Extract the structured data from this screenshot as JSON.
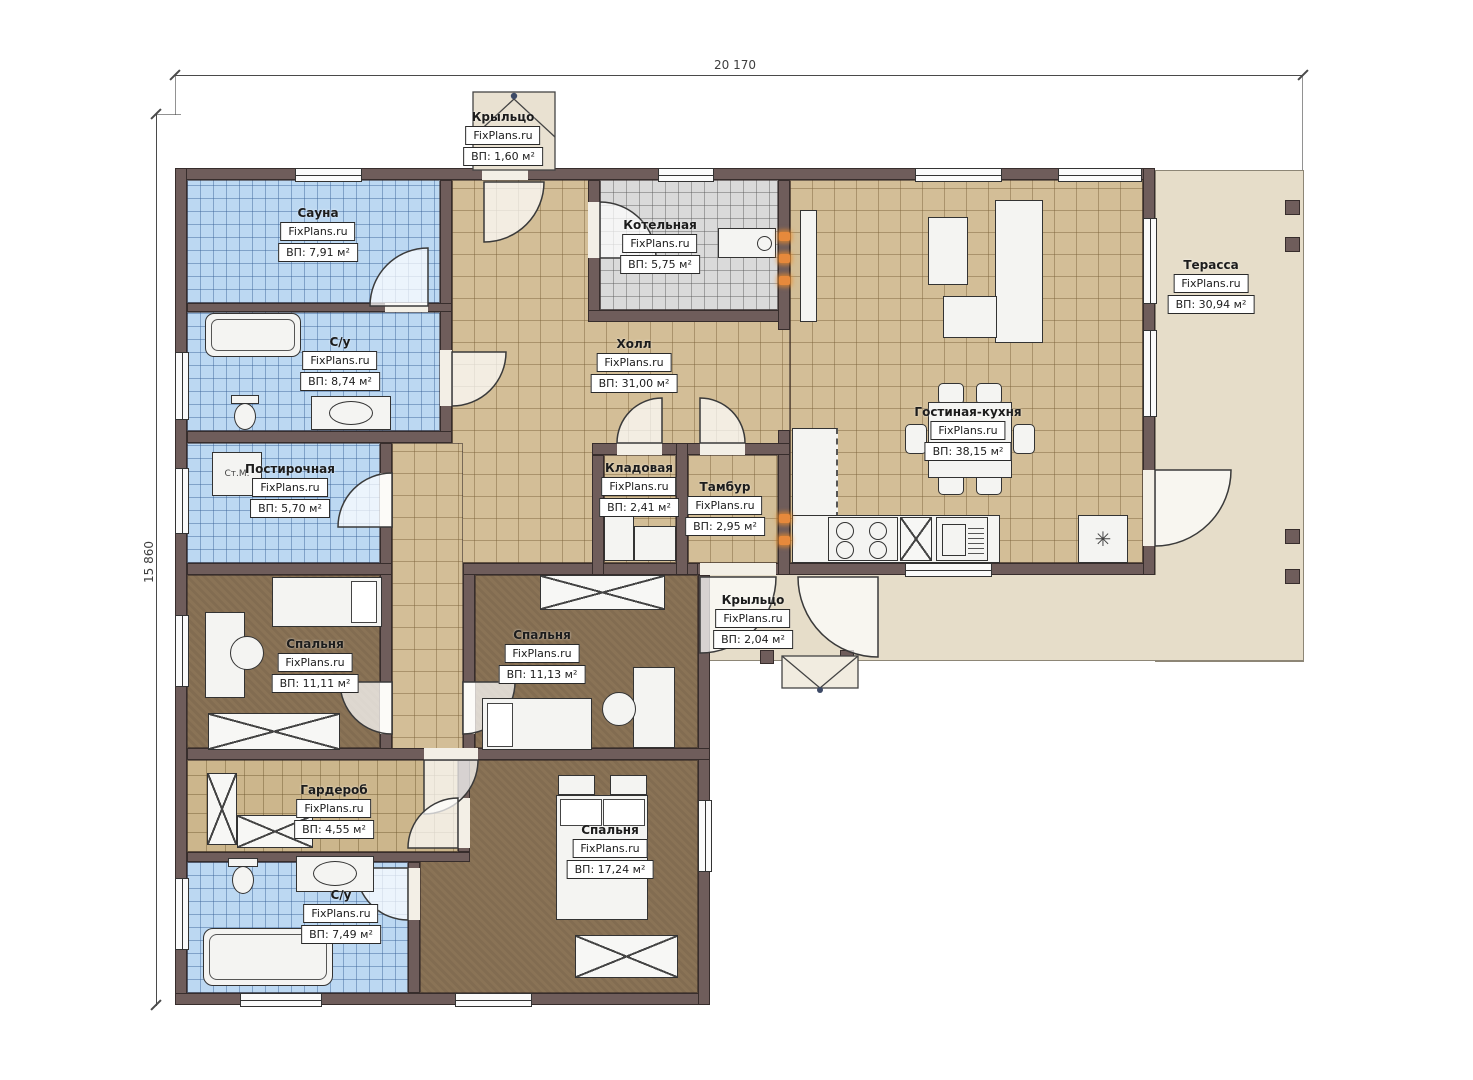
{
  "brand": "FixPlans.ru",
  "dimensions": {
    "width_label": "20 170",
    "height_label": "15 860"
  },
  "fixtures": {
    "washing_machine": "Ст.М.",
    "fridge_symbol": "✳"
  },
  "rooms": [
    {
      "id": "porch-top",
      "name": "Крыльцо",
      "area": "ВП: 1,60 м²"
    },
    {
      "id": "sauna",
      "name": "Сауна",
      "area": "ВП: 7,91 м²"
    },
    {
      "id": "bathroom-1",
      "name": "С/у",
      "area": "ВП: 8,74 м²"
    },
    {
      "id": "boiler",
      "name": "Котельная",
      "area": "ВП: 5,75 м²"
    },
    {
      "id": "hall",
      "name": "Холл",
      "area": "ВП: 31,00 м²"
    },
    {
      "id": "laundry",
      "name": "Постирочная",
      "area": "ВП: 5,70 м²"
    },
    {
      "id": "storage",
      "name": "Кладовая",
      "area": "ВП: 2,41 м²"
    },
    {
      "id": "vestibule",
      "name": "Тамбур",
      "area": "ВП: 2,95 м²"
    },
    {
      "id": "living-kitchen",
      "name": "Гостиная-кухня",
      "area": "ВП: 38,15 м²"
    },
    {
      "id": "terrace",
      "name": "Терасса",
      "area": "ВП: 30,94 м²"
    },
    {
      "id": "bedroom-1",
      "name": "Спальня",
      "area": "ВП: 11,11 м²"
    },
    {
      "id": "bedroom-2",
      "name": "Спальня",
      "area": "ВП: 11,13 м²"
    },
    {
      "id": "wardrobe",
      "name": "Гардероб",
      "area": "ВП: 4,55 м²"
    },
    {
      "id": "bathroom-2",
      "name": "С/у",
      "area": "ВП: 7,49 м²"
    },
    {
      "id": "bedroom-3",
      "name": "Спальня",
      "area": "ВП: 17,24 м²"
    },
    {
      "id": "porch-bottom",
      "name": "Крыльцо",
      "area": "ВП: 2,04 м²"
    }
  ]
}
